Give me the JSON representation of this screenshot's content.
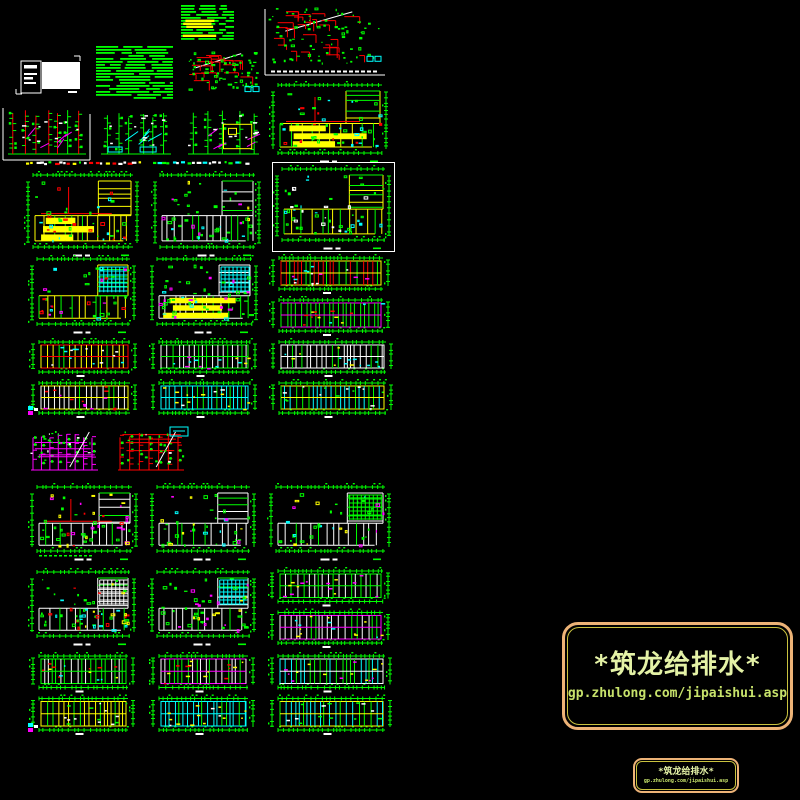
{
  "canvas": {
    "width": 800,
    "height": 800,
    "background": "#000000"
  },
  "cad_colors": {
    "green": "#00FF00",
    "red": "#FF0000",
    "yellow": "#FFFF00",
    "cyan": "#00FFFF",
    "magenta": "#FF00FF",
    "white": "#FFFFFF"
  },
  "stamp": {
    "title": "*筑龙给排水*",
    "url": "gp.zhulong.com/jipaishui.asp",
    "border_color": "#EDB377",
    "inner_border_color": "#C9C23F",
    "title_color": "#E4F2A6",
    "url_color": "#C7E26B"
  },
  "stamp_small": {
    "title": "*筑龙给排水*",
    "url": "gp.zhulong.com/jipaishui.asp"
  },
  "tiles": [
    {
      "name": "sheet-notes-table",
      "kind": "textlist",
      "x": 178,
      "y": 2,
      "w": 61,
      "h": 41,
      "seed": 11,
      "highlight": "#FFFF00",
      "density": 0.8
    },
    {
      "name": "sheet-axonometric-main",
      "kind": "axon",
      "x": 263,
      "y": 3,
      "w": 124,
      "h": 74,
      "seed": 12,
      "frame": true,
      "titleBand": true,
      "count": 26
    },
    {
      "name": "sheet-cover-title-block",
      "kind": "titleblock",
      "x": 14,
      "y": 52,
      "w": 68,
      "h": 44,
      "seed": 13
    },
    {
      "name": "sheet-spec-notes",
      "kind": "textlist",
      "x": 93,
      "y": 43,
      "w": 85,
      "h": 61,
      "seed": 14,
      "density": 1.4
    },
    {
      "name": "sheet-axonometric-2",
      "kind": "axon",
      "x": 180,
      "y": 47,
      "w": 85,
      "h": 55,
      "seed": 15,
      "count": 18
    },
    {
      "name": "sheet-plan-top-right",
      "kind": "plan",
      "x": 268,
      "y": 78,
      "w": 124,
      "h": 87,
      "seed": 16,
      "wall": "#FFFF00",
      "bands": "#FFFF00",
      "pipe": "#FF0000",
      "accents": [
        "#FF0000",
        "#00FFFF"
      ]
    },
    {
      "name": "sheet-riser-1",
      "kind": "riser",
      "x": 2,
      "y": 104,
      "w": 90,
      "h": 58,
      "seed": 17,
      "accent": "#FF00FF",
      "vert": "#FF0000",
      "frame": true
    },
    {
      "name": "sheet-riser-2",
      "kind": "riser",
      "x": 95,
      "y": 106,
      "w": 82,
      "h": 56,
      "seed": 18,
      "accent": "#00FFFF",
      "vert": "#00FF00",
      "pools": true
    },
    {
      "name": "sheet-riser-3",
      "kind": "riser",
      "x": 182,
      "y": 104,
      "w": 83,
      "h": 58,
      "seed": 19,
      "accent": "#FF00FF",
      "vert": "#00FF00",
      "yellowBox": true
    },
    {
      "name": "legend-strip-1",
      "kind": "strip",
      "x": 25,
      "y": 160,
      "w": 118,
      "h": 7,
      "seed": 20,
      "colors": [
        "#FFFFFF",
        "#00FF00",
        "#FFFF00",
        "#FF0000"
      ]
    },
    {
      "name": "legend-strip-2",
      "kind": "strip",
      "x": 152,
      "y": 160,
      "w": 100,
      "h": 7,
      "seed": 21,
      "colors": [
        "#00FF00",
        "#FFFFFF",
        "#00FFFF"
      ]
    },
    {
      "name": "sheet-plan-d1",
      "kind": "plan",
      "x": 23,
      "y": 168,
      "w": 120,
      "h": 91,
      "seed": 22,
      "wall": "#FFFF00",
      "bands": "#FFFF00",
      "pipe": "#FF0000",
      "accents": [
        "#00FFFF",
        "#FF0000"
      ]
    },
    {
      "name": "sheet-plan-d2",
      "kind": "plan",
      "x": 150,
      "y": 168,
      "w": 115,
      "h": 91,
      "seed": 23,
      "wall": "#FFFFFF",
      "accents": [
        "#FF00FF",
        "#00FFFF",
        "#FFFF00"
      ]
    },
    {
      "name": "sheet-plan-d3",
      "kind": "plan",
      "x": 272,
      "y": 162,
      "w": 123,
      "h": 90,
      "seed": 24,
      "frame": true,
      "wall": "#FFFF00",
      "accents": [
        "#FFFFFF",
        "#00FFFF"
      ]
    },
    {
      "name": "sheet-plan-e1",
      "kind": "plan",
      "x": 27,
      "y": 252,
      "w": 113,
      "h": 84,
      "seed": 25,
      "wall": "#FFFF00",
      "grid": "#00FFFF",
      "accents": [
        "#FF00FF",
        "#00FFFF",
        "#FF0000"
      ]
    },
    {
      "name": "sheet-plan-e2",
      "kind": "plan",
      "x": 147,
      "y": 252,
      "w": 115,
      "h": 84,
      "seed": 26,
      "wall": "#FFFFFF",
      "grid": "#00FFFF",
      "bands": "#FFFF00",
      "accents": [
        "#00FFFF",
        "#FF00FF"
      ]
    },
    {
      "name": "sheet-strips-e3",
      "kind": "strippair",
      "x": 267,
      "y": 252,
      "w": 128,
      "h": 84,
      "seed": 27,
      "bandsSpec": [
        {
          "border": "#FFFF00",
          "cell": "#FF0000",
          "acc": [
            "#00FFFF",
            "#FFFFFF",
            "#FF00FF"
          ]
        },
        {
          "border": "#FF00FF",
          "cell": "#00FF00",
          "acc": [
            "#FF0000",
            "#00FFFF",
            "#FFFF00"
          ]
        }
      ]
    },
    {
      "name": "sheet-strips-f1",
      "kind": "strippair",
      "x": 27,
      "y": 336,
      "w": 115,
      "h": 82,
      "seed": 28,
      "glyph": true,
      "bandsSpec": [
        {
          "border": "#FF0000",
          "cell": "#FFFF00",
          "acc": [
            "#FFFFFF",
            "#00FFFF"
          ]
        },
        {
          "border": "#FFFF00",
          "cell": "#FFFFFF",
          "acc": [
            "#FF0000",
            "#FF00FF"
          ]
        }
      ]
    },
    {
      "name": "sheet-strips-f2",
      "kind": "strippair",
      "x": 147,
      "y": 336,
      "w": 115,
      "h": 82,
      "seed": 29,
      "bandsSpec": [
        {
          "border": "#00FF00",
          "cell": "#FFFFFF",
          "acc": [
            "#00FFFF",
            "#FFFF00",
            "#FF00FF"
          ]
        },
        {
          "border": "#00FFFF",
          "cell": "#00FFFF",
          "acc": [
            "#FFFFFF",
            "#FFFF00"
          ]
        }
      ]
    },
    {
      "name": "sheet-strips-f3",
      "kind": "strippair",
      "x": 267,
      "y": 336,
      "w": 131,
      "h": 82,
      "seed": 30,
      "bandsSpec": [
        {
          "border": "#FFFFFF",
          "cell": "#FFFFFF",
          "acc": [
            "#00FFFF",
            "#FFFF00"
          ]
        },
        {
          "border": "#FFFF00",
          "cell": "#00FFFF",
          "acc": [
            "#00FF00",
            "#FFFFFF"
          ]
        }
      ]
    },
    {
      "name": "sheet-schematic-magenta",
      "kind": "schem",
      "x": 23,
      "y": 424,
      "w": 85,
      "h": 53,
      "seed": 31,
      "main": "#FF00FF"
    },
    {
      "name": "sheet-schematic-red",
      "kind": "schem",
      "x": 110,
      "y": 424,
      "w": 84,
      "h": 53,
      "seed": 32,
      "main": "#FF0000",
      "cyanGlyph": true
    },
    {
      "name": "sheet-plan-h1",
      "kind": "plan",
      "x": 27,
      "y": 480,
      "w": 115,
      "h": 83,
      "seed": 33,
      "wall": "#FFFFFF",
      "pipe": "#FF0000",
      "strip": true,
      "accents": [
        "#FF00FF",
        "#FFFF00",
        "#FF0000"
      ]
    },
    {
      "name": "sheet-plan-h2",
      "kind": "plan",
      "x": 147,
      "y": 480,
      "w": 113,
      "h": 83,
      "seed": 34,
      "wall": "#FFFFFF",
      "accents": [
        "#FFFF00",
        "#00FFFF",
        "#FF00FF"
      ]
    },
    {
      "name": "sheet-plan-h3",
      "kind": "plan",
      "x": 266,
      "y": 480,
      "w": 129,
      "h": 83,
      "seed": 35,
      "wall": "#FFFFFF",
      "grid": "#00FF00",
      "accents": [
        "#00FFFF",
        "#FF00FF",
        "#FFFF00"
      ]
    },
    {
      "name": "sheet-plan-i1",
      "kind": "plan",
      "x": 27,
      "y": 565,
      "w": 113,
      "h": 83,
      "seed": 36,
      "wall": "#FFFFFF",
      "grid": "#FFFFFF",
      "accents": [
        "#00FFFF",
        "#FF0000",
        "#FFFF00"
      ]
    },
    {
      "name": "sheet-plan-i2",
      "kind": "plan",
      "x": 147,
      "y": 565,
      "w": 113,
      "h": 83,
      "seed": 37,
      "wall": "#FFFFFF",
      "grid": "#00FFFF",
      "accents": [
        "#FFFF00",
        "#FF00FF"
      ]
    },
    {
      "name": "sheet-strips-i3",
      "kind": "strippair",
      "x": 266,
      "y": 565,
      "w": 129,
      "h": 83,
      "seed": 38,
      "bandsSpec": [
        {
          "border": "#00FF00",
          "cell": "#FFFFFF",
          "acc": [
            "#FFFF00",
            "#FF00FF"
          ]
        },
        {
          "border": "#FF00FF",
          "cell": "#FFFFFF",
          "acc": [
            "#FFFF00",
            "#00FFFF"
          ]
        }
      ]
    },
    {
      "name": "sheet-strips-j1",
      "kind": "strippair",
      "x": 27,
      "y": 650,
      "w": 113,
      "h": 85,
      "seed": 39,
      "glyph": true,
      "bandsSpec": [
        {
          "border": "#00FF00",
          "cell": "#FFFFFF",
          "acc": [
            "#00FFFF",
            "#FFFF00",
            "#FF0000"
          ]
        },
        {
          "border": "#FFFF00",
          "cell": "#FFFF00",
          "acc": [
            "#FFFFFF",
            "#00FF00"
          ]
        }
      ]
    },
    {
      "name": "sheet-strips-j2",
      "kind": "strippair",
      "x": 147,
      "y": 650,
      "w": 113,
      "h": 85,
      "seed": 40,
      "bandsSpec": [
        {
          "border": "#FF00FF",
          "cell": "#FFFFFF",
          "acc": [
            "#FF0000",
            "#FFFF00"
          ]
        },
        {
          "border": "#00FFFF",
          "cell": "#00FFFF",
          "acc": [
            "#FFFFFF",
            "#FFFF00"
          ]
        }
      ]
    },
    {
      "name": "sheet-strips-j3",
      "kind": "strippair",
      "x": 266,
      "y": 650,
      "w": 131,
      "h": 85,
      "seed": 41,
      "bandsSpec": [
        {
          "border": "#FFFFFF",
          "cell": "#00FFFF",
          "acc": [
            "#FFFF00",
            "#FF00FF"
          ]
        },
        {
          "border": "#FFFF00",
          "cell": "#00FFFF",
          "acc": [
            "#FFFFFF",
            "#00FF00"
          ]
        }
      ]
    }
  ]
}
